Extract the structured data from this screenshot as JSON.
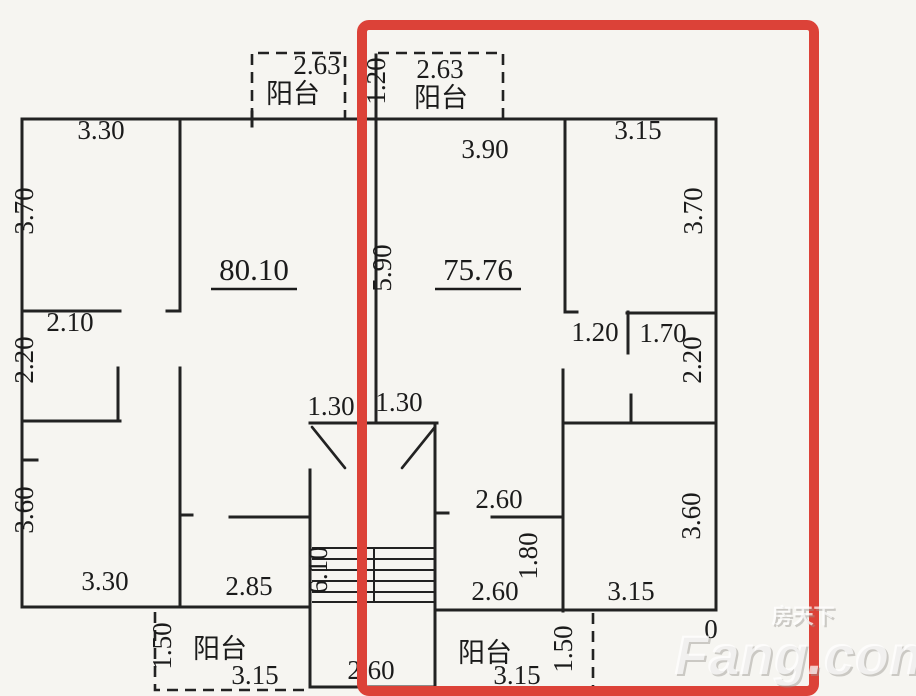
{
  "canvas": {
    "width": 916,
    "height": 696,
    "background": "#f6f5f1",
    "line_color": "#222222"
  },
  "highlight": {
    "color": "#dc4238",
    "x": 362,
    "y": 25,
    "width": 452,
    "height": 666,
    "stroke_width": 10
  },
  "watermark": {
    "cn": "房天下",
    "latin": "Fang.com",
    "color": "rgba(255,255,255,0.72)",
    "shadow": "rgba(150,148,142,0.45)"
  },
  "areas_note": "80.10 and 75.76 are the underlined floor-area figures of the two units",
  "labels": [
    {
      "t": "2.63",
      "x": 317,
      "y": 74
    },
    {
      "t": "阳台",
      "x": 293,
      "y": 103,
      "cn": true
    },
    {
      "t": "1.20",
      "x": 385,
      "y": 81,
      "r": true
    },
    {
      "t": "2.63",
      "x": 440,
      "y": 78
    },
    {
      "t": "阳台",
      "x": 441,
      "y": 107,
      "cn": true
    },
    {
      "t": "3.30",
      "x": 101,
      "y": 139
    },
    {
      "t": "3.90",
      "x": 485,
      "y": 158
    },
    {
      "t": "3.15",
      "x": 638,
      "y": 139
    },
    {
      "t": "3.70",
      "x": 33,
      "y": 211,
      "r": true
    },
    {
      "t": "3.70",
      "x": 702,
      "y": 211,
      "r": true
    },
    {
      "t": "80.10",
      "x": 254,
      "y": 280,
      "u": true,
      "big": true
    },
    {
      "t": "75.76",
      "x": 478,
      "y": 280,
      "u": true,
      "big": true
    },
    {
      "t": "5.90",
      "x": 391,
      "y": 268,
      "r": true
    },
    {
      "t": "2.10",
      "x": 70,
      "y": 331
    },
    {
      "t": "2.20",
      "x": 33,
      "y": 360,
      "r": true
    },
    {
      "t": "1.20",
      "x": 595,
      "y": 341
    },
    {
      "t": "1.70",
      "x": 663,
      "y": 342
    },
    {
      "t": "2.20",
      "x": 701,
      "y": 360,
      "r": true
    },
    {
      "t": "1.30",
      "x": 331,
      "y": 415
    },
    {
      "t": "1.30",
      "x": 399,
      "y": 411
    },
    {
      "t": "3.60",
      "x": 33,
      "y": 510,
      "r": true
    },
    {
      "t": "2.60",
      "x": 499,
      "y": 508
    },
    {
      "t": "1.80",
      "x": 537,
      "y": 556,
      "r": true
    },
    {
      "t": "2.60",
      "x": 495,
      "y": 600
    },
    {
      "t": "3.60",
      "x": 700,
      "y": 516,
      "r": true
    },
    {
      "t": "3.15",
      "x": 631,
      "y": 600
    },
    {
      "t": "2.85",
      "x": 249,
      "y": 595
    },
    {
      "t": "3.30",
      "x": 105,
      "y": 590
    },
    {
      "t": "6.10",
      "x": 327,
      "y": 570,
      "r": true
    },
    {
      "t": "2.60",
      "x": 371,
      "y": 679
    },
    {
      "t": "1.50",
      "x": 171,
      "y": 646,
      "r": true
    },
    {
      "t": "阳台",
      "x": 220,
      "y": 658,
      "cn": true
    },
    {
      "t": "3.15",
      "x": 255,
      "y": 684
    },
    {
      "t": "阳台",
      "x": 485,
      "y": 662,
      "cn": true
    },
    {
      "t": "3.15",
      "x": 517,
      "y": 684
    },
    {
      "t": "1.50",
      "x": 572,
      "y": 649,
      "r": true
    },
    {
      "t": "0",
      "x": 711,
      "y": 638
    }
  ]
}
